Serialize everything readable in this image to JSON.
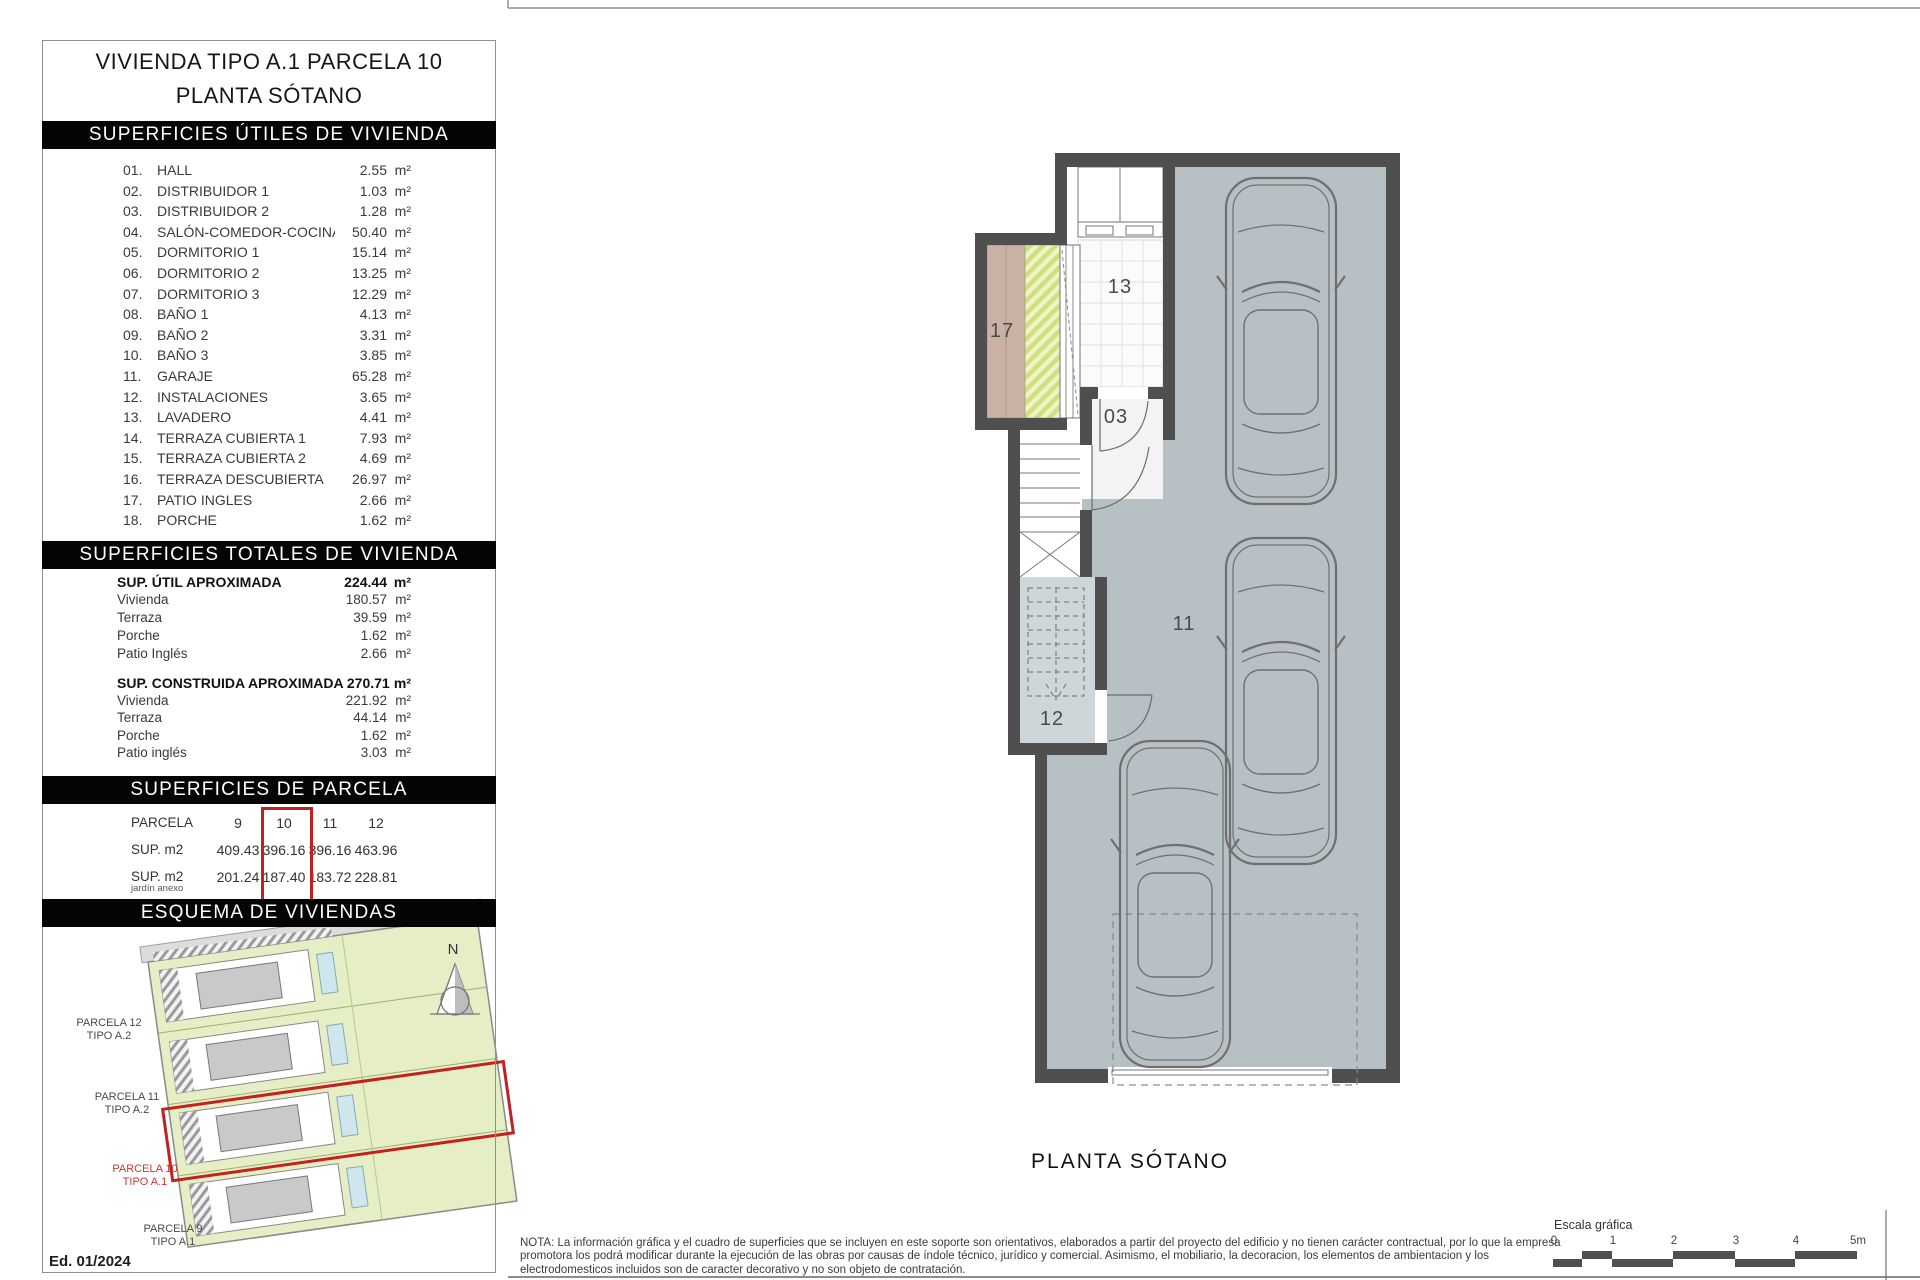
{
  "units": {
    "m2": "m²"
  },
  "colors": {
    "accent_red": "#c42020",
    "wall_gray": "#4f4f4f",
    "garage_floor": "#b7c1c5",
    "room12_floor": "#cdd6d9",
    "patio_brown": "#c9b2a4",
    "garden_green": "#e6eec6",
    "header_bar": "#050505"
  },
  "title": {
    "line1": "VIVIENDA TIPO A.1 PARCELA 10",
    "line2": "PLANTA SÓTANO"
  },
  "useful": {
    "heading": "SUPERFICIES ÚTILES DE VIVIENDA",
    "rows": [
      {
        "num": "01.",
        "name": "HALL",
        "value": "2.55"
      },
      {
        "num": "02.",
        "name": "DISTRIBUIDOR 1",
        "value": "1.03"
      },
      {
        "num": "03.",
        "name": "DISTRIBUIDOR 2",
        "value": "1.28"
      },
      {
        "num": "04.",
        "name": "SALÓN-COMEDOR-COCINA",
        "value": "50.40"
      },
      {
        "num": "05.",
        "name": "DORMITORIO 1",
        "value": "15.14"
      },
      {
        "num": "06.",
        "name": "DORMITORIO 2",
        "value": "13.25"
      },
      {
        "num": "07.",
        "name": "DORMITORIO 3",
        "value": "12.29"
      },
      {
        "num": "08.",
        "name": "BAÑO 1",
        "value": "4.13"
      },
      {
        "num": "09.",
        "name": "BAÑO 2",
        "value": "3.31"
      },
      {
        "num": "10.",
        "name": "BAÑO 3",
        "value": "3.85"
      },
      {
        "num": "11.",
        "name": "GARAJE",
        "value": "65.28"
      },
      {
        "num": "12.",
        "name": "INSTALACIONES",
        "value": "3.65"
      },
      {
        "num": "13.",
        "name": "LAVADERO",
        "value": "4.41"
      },
      {
        "num": "14.",
        "name": "TERRAZA CUBIERTA 1",
        "value": "7.93"
      },
      {
        "num": "15.",
        "name": "TERRAZA CUBIERTA 2",
        "value": "4.69"
      },
      {
        "num": "16.",
        "name": "TERRAZA DESCUBIERTA",
        "value": "26.97"
      },
      {
        "num": "17.",
        "name": "PATIO INGLES",
        "value": "2.66"
      },
      {
        "num": "18.",
        "name": "PORCHE",
        "value": "1.62"
      }
    ]
  },
  "totals": {
    "heading": "SUPERFICIES TOTALES DE VIVIENDA",
    "useful_total": {
      "label": "SUP. ÚTIL APROXIMADA",
      "value": "224.44",
      "items": [
        {
          "label": "Vivienda",
          "value": "180.57"
        },
        {
          "label": "Terraza",
          "value": "39.59"
        },
        {
          "label": "Porche",
          "value": "1.62"
        },
        {
          "label": "Patio Inglés",
          "value": "2.66"
        }
      ]
    },
    "built_total": {
      "label": "SUP. CONSTRUIDA APROXIMADA",
      "value": "270.71",
      "items": [
        {
          "label": "Vivienda",
          "value": "221.92"
        },
        {
          "label": "Terraza",
          "value": "44.14"
        },
        {
          "label": "Porche",
          "value": "1.62"
        },
        {
          "label": "Patio inglés",
          "value": "3.03"
        }
      ]
    }
  },
  "parcel": {
    "heading": "SUPERFICIES DE PARCELA",
    "row_label": "PARCELA",
    "area_label": "SUP. m2",
    "garden_label": "SUP. m2",
    "garden_sublabel": "jardín anexo",
    "columns": [
      "9",
      "10",
      "11",
      "12"
    ],
    "areas": [
      "409.43",
      "396.16",
      "396.16",
      "463.96"
    ],
    "garden_areas": [
      "201.24",
      "187.40",
      "183.72",
      "228.81"
    ],
    "highlighted_column": "10"
  },
  "scheme": {
    "heading": "ESQUEMA DE VIVIENDAS",
    "north": "N",
    "edition": "Ed. 01/2024",
    "labels": [
      {
        "name": "PARCELA 12",
        "type": "TIPO A.2"
      },
      {
        "name": "PARCELA 11",
        "type": "TIPO A.2"
      },
      {
        "name": "PARCELA 10",
        "type": "TIPO A.1"
      },
      {
        "name": "PARCELA 9",
        "type": "TIPO A.1"
      }
    ]
  },
  "plan": {
    "caption": "PLANTA SÓTANO",
    "rooms": {
      "r17": "17",
      "r13": "13",
      "r03": "03",
      "r11": "11",
      "r12": "12"
    }
  },
  "footer": {
    "note": "NOTA: La información gráfica y el cuadro de superficies que se incluyen en este soporte son orientativos, elaborados a partir del proyecto del edificio y no tienen carácter contractual, por lo que la empresa promotora los podrá modificar durante la ejecución de las obras por causas de índole técnico, jurídico y comercial. Asimismo, el mobiliario, la decoracion, los elementos de ambientacion y los electrodomesticos incluidos son de caracter decorativo y no son objeto de contratación.",
    "scale_label": "Escala gráfica",
    "ticks": [
      "0",
      "1",
      "2",
      "3",
      "4",
      "5m"
    ]
  }
}
